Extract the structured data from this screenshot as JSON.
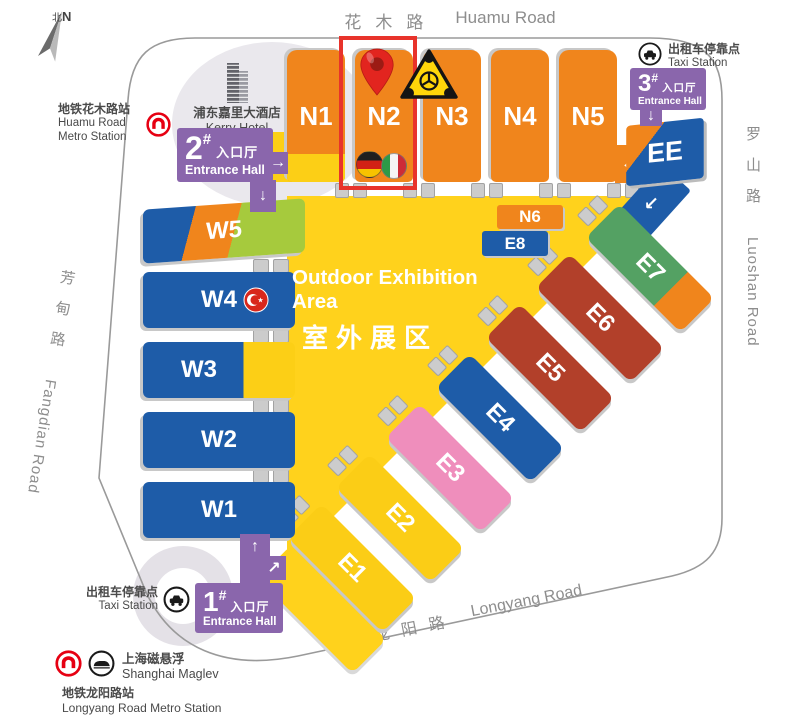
{
  "map": {
    "compass": {
      "zh": "北",
      "en": "N"
    },
    "roads": {
      "huamu_zh": "花木路",
      "huamu_en": "Huamu Road",
      "luoshan_zh": "罗山路",
      "luoshan_en": "Luoshan Road",
      "fangdian_zh": "芳甸路",
      "fangdian_en": "Fangdian Road",
      "longyang_zh": "龙阳路",
      "longyang_en": "Longyang Road"
    },
    "stations": {
      "huamu_metro_zh": "地铁花木路站",
      "huamu_metro_en1": "Huamu Road",
      "huamu_metro_en2": "Metro Station",
      "taxi_zh": "出租车停靠点",
      "taxi_en": "Taxi Station",
      "maglev_zh": "上海磁悬浮",
      "maglev_en": "Shanghai Maglev",
      "longyang_metro_zh": "地铁龙阳路站",
      "longyang_metro_en": "Longyang Road Metro Station"
    },
    "hotel": {
      "zh": "浦东嘉里大酒店",
      "en": "Kerry Hotel"
    },
    "entrances": [
      {
        "num": "1",
        "mark": "#",
        "zh": "入口厅",
        "en": "Entrance Hall"
      },
      {
        "num": "2",
        "mark": "#",
        "zh": "入口厅",
        "en": "Entrance Hall"
      },
      {
        "num": "3",
        "mark": "#",
        "zh": "入口厅",
        "en": "Entrance Hall"
      }
    ],
    "outdoor": {
      "en": "Outdoor Exhibition Area",
      "zh": "室外展区"
    },
    "halls": {
      "north": [
        "N1",
        "N2",
        "N3",
        "N4",
        "N5"
      ],
      "inner": [
        "N6",
        "E8"
      ],
      "west": [
        "W5",
        "W4",
        "W3",
        "W2",
        "W1"
      ],
      "east": [
        "E7",
        "E6",
        "E5",
        "E4",
        "E3",
        "E2",
        "E1"
      ],
      "ee": "EE"
    },
    "arrows": {
      "up": "↑",
      "down": "↓",
      "left": "←",
      "right": "→",
      "downleft": "↙",
      "upright": "↗"
    },
    "colors": {
      "orange": "#f0851c",
      "blue": "#1e5ca8",
      "yellow": "#ffd21c",
      "purple": "#8a66ac",
      "green": "#54a163",
      "lime": "#a6ca3d",
      "brick": "#b2402a",
      "pink": "#ef8ebc",
      "highlight_red": "#e8332b",
      "metro_red": "#e60012"
    }
  }
}
